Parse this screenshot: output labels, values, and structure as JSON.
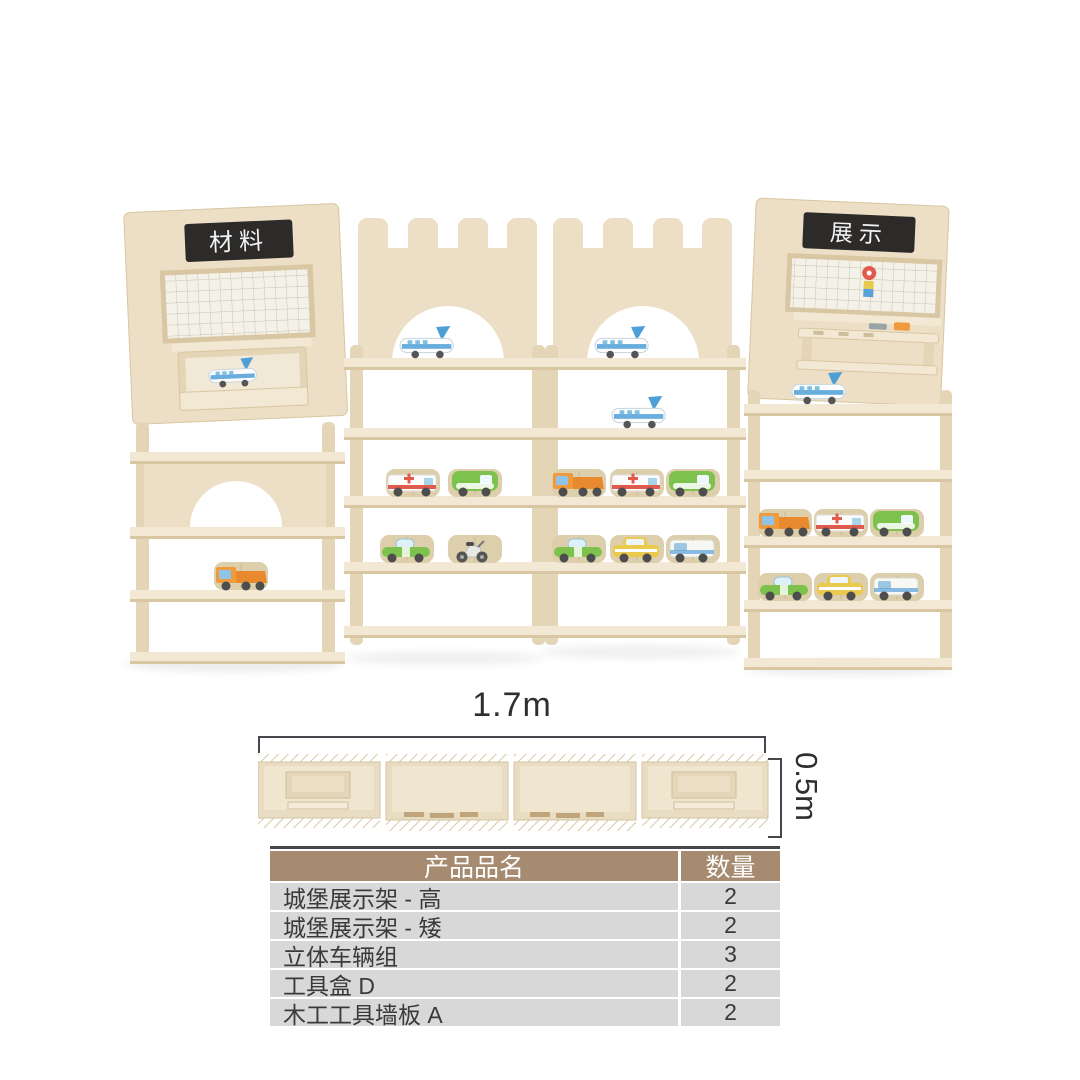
{
  "colors": {
    "wood": "#ecdfc6",
    "wood-edge": "#d9c6a2",
    "wood-side": "#e4d5b6",
    "wood-shelf": "#f2e8d4",
    "sign-bg": "#2d2b29",
    "table-header-bg": "#a68b71",
    "table-row-bg": "#d8d8d8",
    "table-text": "#3a3a3a",
    "toy-blue": "#4d9fd6",
    "toy-orange": "#ef9a3c",
    "toy-green": "#7cc24d",
    "toy-yellow": "#e9c94e",
    "toy-red": "#e05a4e"
  },
  "photo": {
    "left_sign": "材料",
    "right_sign": "展示"
  },
  "dimensions": {
    "width_label": "1.7m",
    "height_label": "0.5m"
  },
  "table": {
    "headers": [
      "产品品名",
      "数量"
    ],
    "rows": [
      {
        "name": "城堡展示架 - 高",
        "qty": "2"
      },
      {
        "name": "城堡展示架 - 矮",
        "qty": "2"
      },
      {
        "name": "立体车辆组",
        "qty": "3"
      },
      {
        "name": "工具盒 D",
        "qty": "2"
      },
      {
        "name": "木工工具墙板 A",
        "qty": "2"
      }
    ]
  }
}
